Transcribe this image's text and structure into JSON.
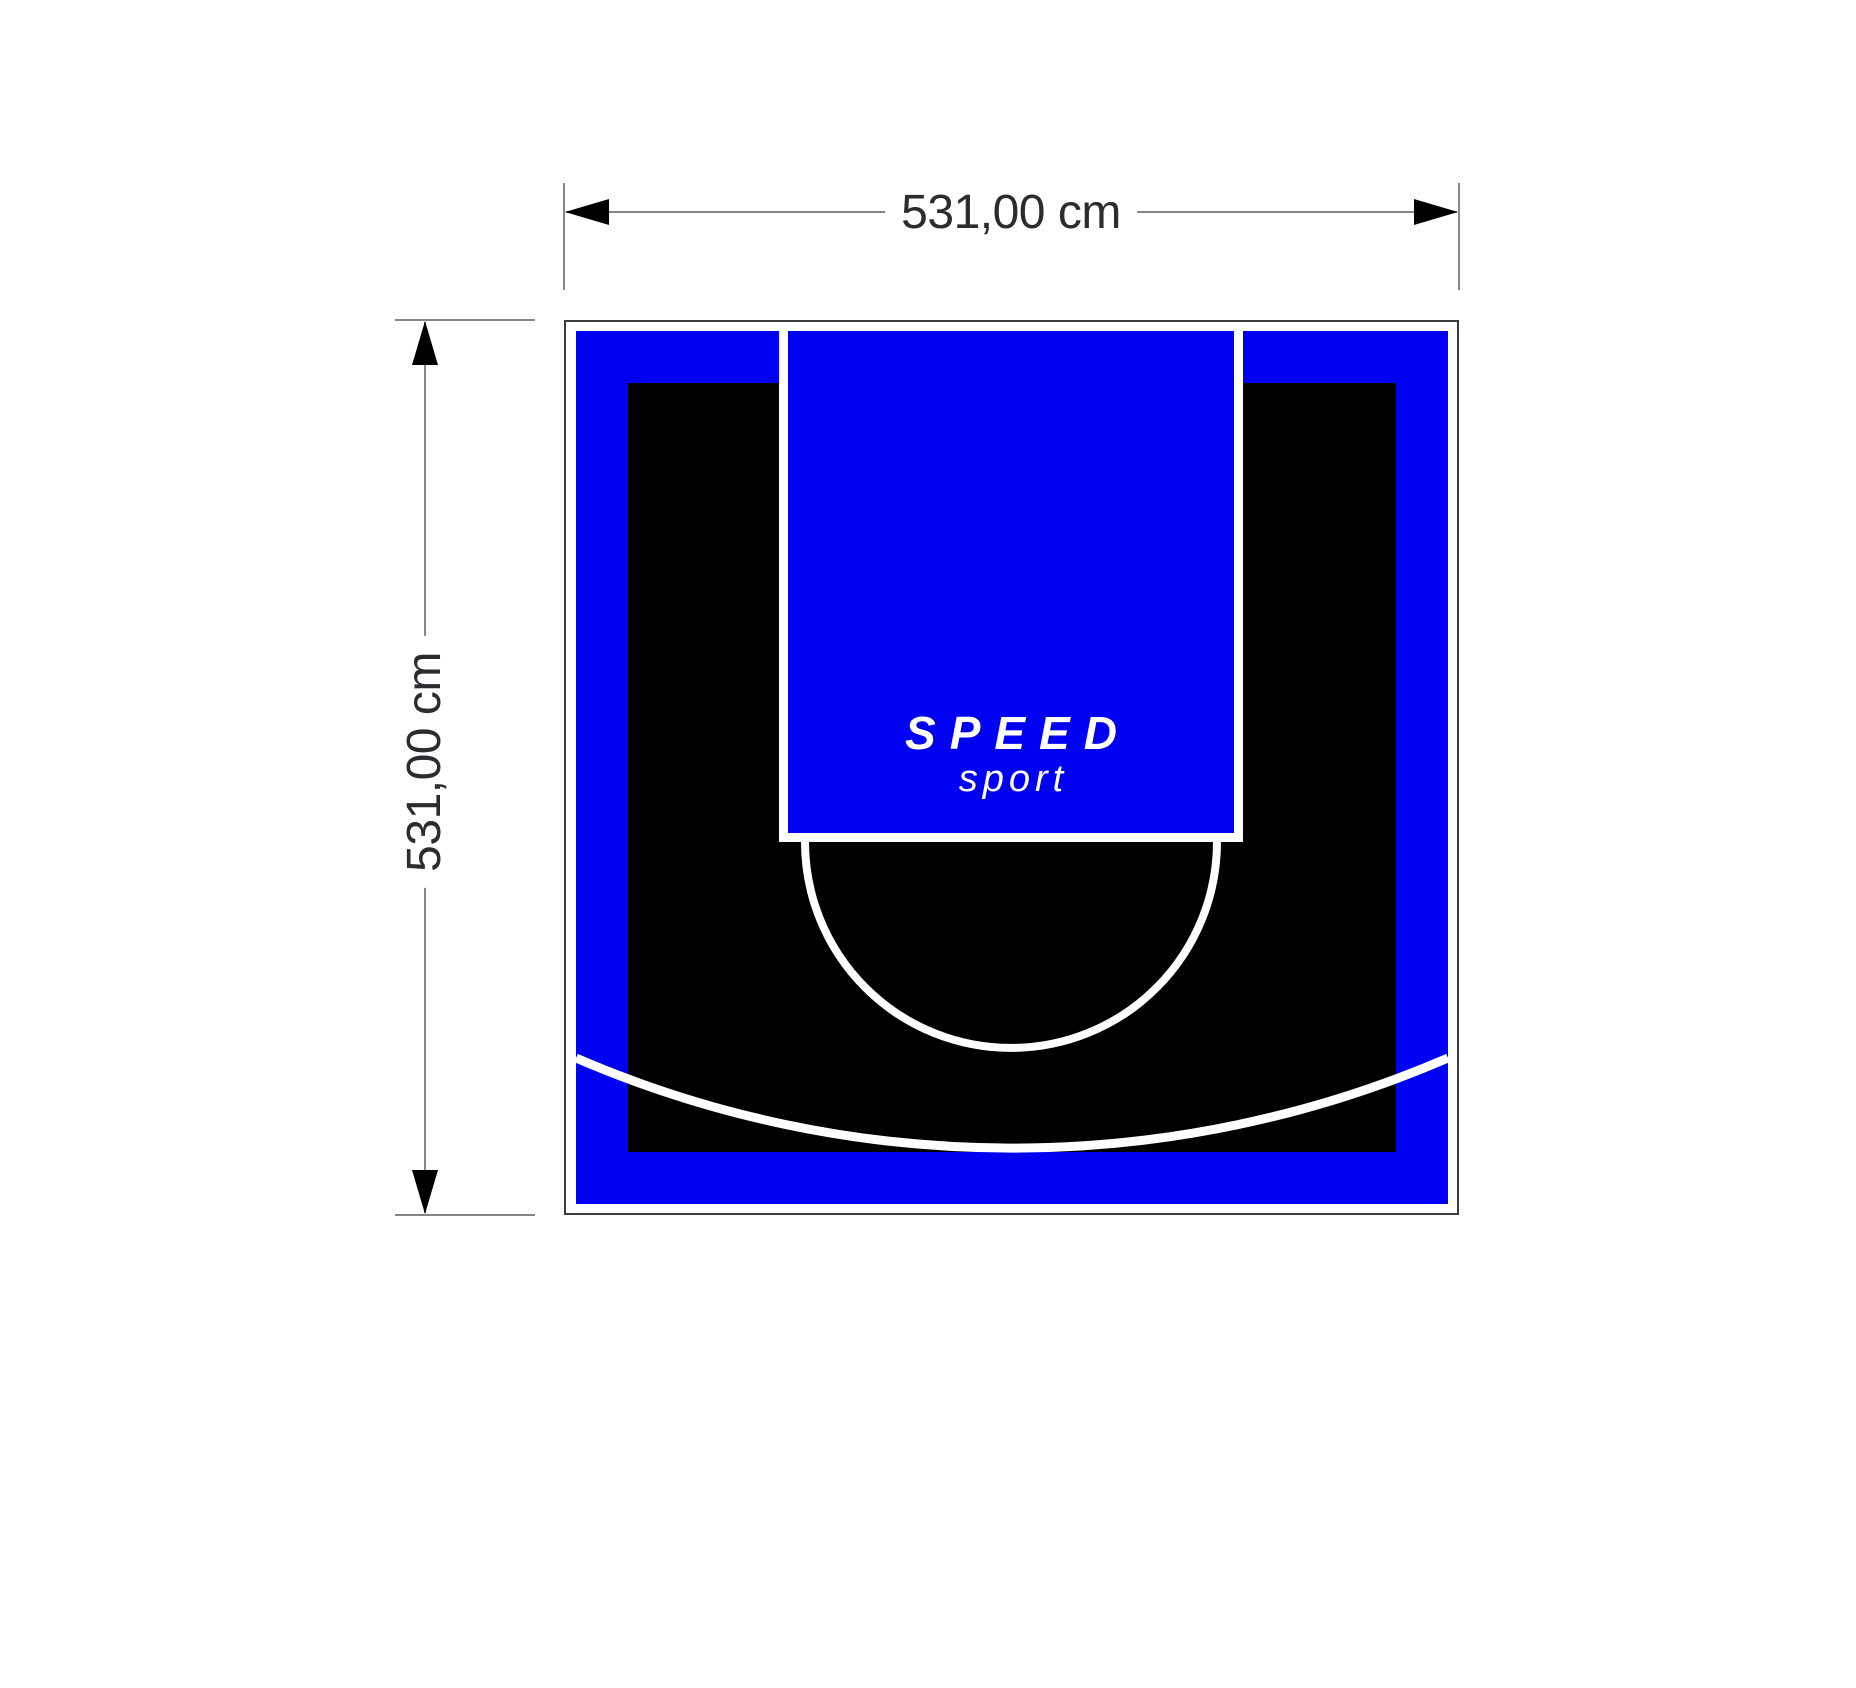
{
  "dimensions": {
    "width_label": "531,00 cm",
    "height_label": "531,00 cm"
  },
  "logo": {
    "line1": "SPEED",
    "line2": "sport"
  },
  "colors": {
    "court_blue": "#0000f2",
    "court_black": "#000000",
    "marking_white": "#ffffff",
    "outline_dark": "#3b3b3f",
    "dimension_line_gray": "#87878b",
    "dimension_text_dark": "#2b2b30",
    "page_background": "#ffffff"
  }
}
